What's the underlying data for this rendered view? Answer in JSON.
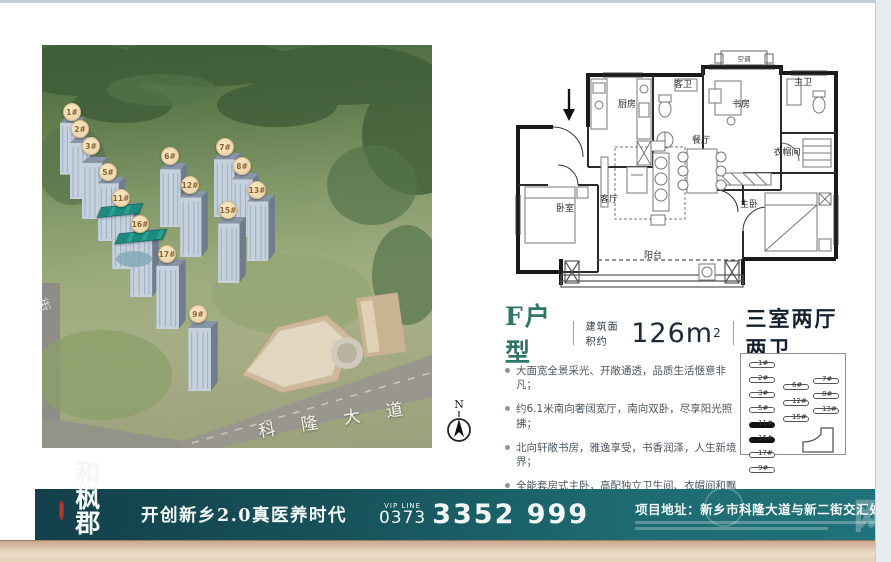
{
  "aerial": {
    "road_label": "科隆大道",
    "side_road_label": "街",
    "badges": [
      "1#",
      "2#",
      "3#",
      "5#",
      "6#",
      "7#",
      "8#",
      "11#",
      "12#",
      "13#",
      "15#",
      "16#",
      "17#",
      "9#"
    ]
  },
  "compass": {
    "label": "N"
  },
  "floorplan": {
    "rooms": {
      "kitchen": "厨房",
      "guest_bath": "客卫",
      "study": "书房",
      "master_bath": "主卫",
      "cloakroom": "衣帽间",
      "dining": "餐厅",
      "living": "客厅",
      "bedroom": "卧室",
      "master_bedroom": "主卧",
      "balcony": "阳台",
      "ac": "空调"
    }
  },
  "unit_info": {
    "unit_name": "F户型",
    "area_prefix": "建筑面积约",
    "area_value": "126m",
    "area_sup": "2",
    "layout": "三室两厅两卫",
    "features": [
      "大面宽全景采光、开敞通透，品质生活惬意非凡；",
      "约6.1米南向奢阔宽厅，南向双卧，尽享阳光照拂；",
      "北向轩敞书房，雅逸享受，书香润泽，人生新境界；",
      "全能套房式主卧，高配独立卫生间、衣帽间和飘窗。"
    ]
  },
  "sitemap": {
    "col_left": [
      "1#",
      "2#",
      "3#",
      "5#",
      "11#",
      "16#",
      "17#",
      "9#"
    ],
    "col_mid": [
      "6#",
      "12#",
      "15#"
    ],
    "col_right": [
      "7#",
      "8#",
      "13#"
    ]
  },
  "banner": {
    "brand": "和枫郡",
    "brand_tagline": "领创5U医养新典范",
    "slogan": "开创新乡2.0真医养时代",
    "vip_line_label": "VIP LINE",
    "phone_prefix": "0373",
    "phone_number": "3352 999",
    "address": "项目地址：新乡市科隆大道与新二街交汇处",
    "watermark": "网"
  },
  "colors": {
    "banner_teal_dark": "#13404a",
    "banner_teal_light": "#20727a",
    "unit_name_teal": "#2f7468",
    "badge_tan": "#ecd3a4",
    "seal_red": "#c03a2b",
    "highlight_roof": "#1d8a7e"
  }
}
